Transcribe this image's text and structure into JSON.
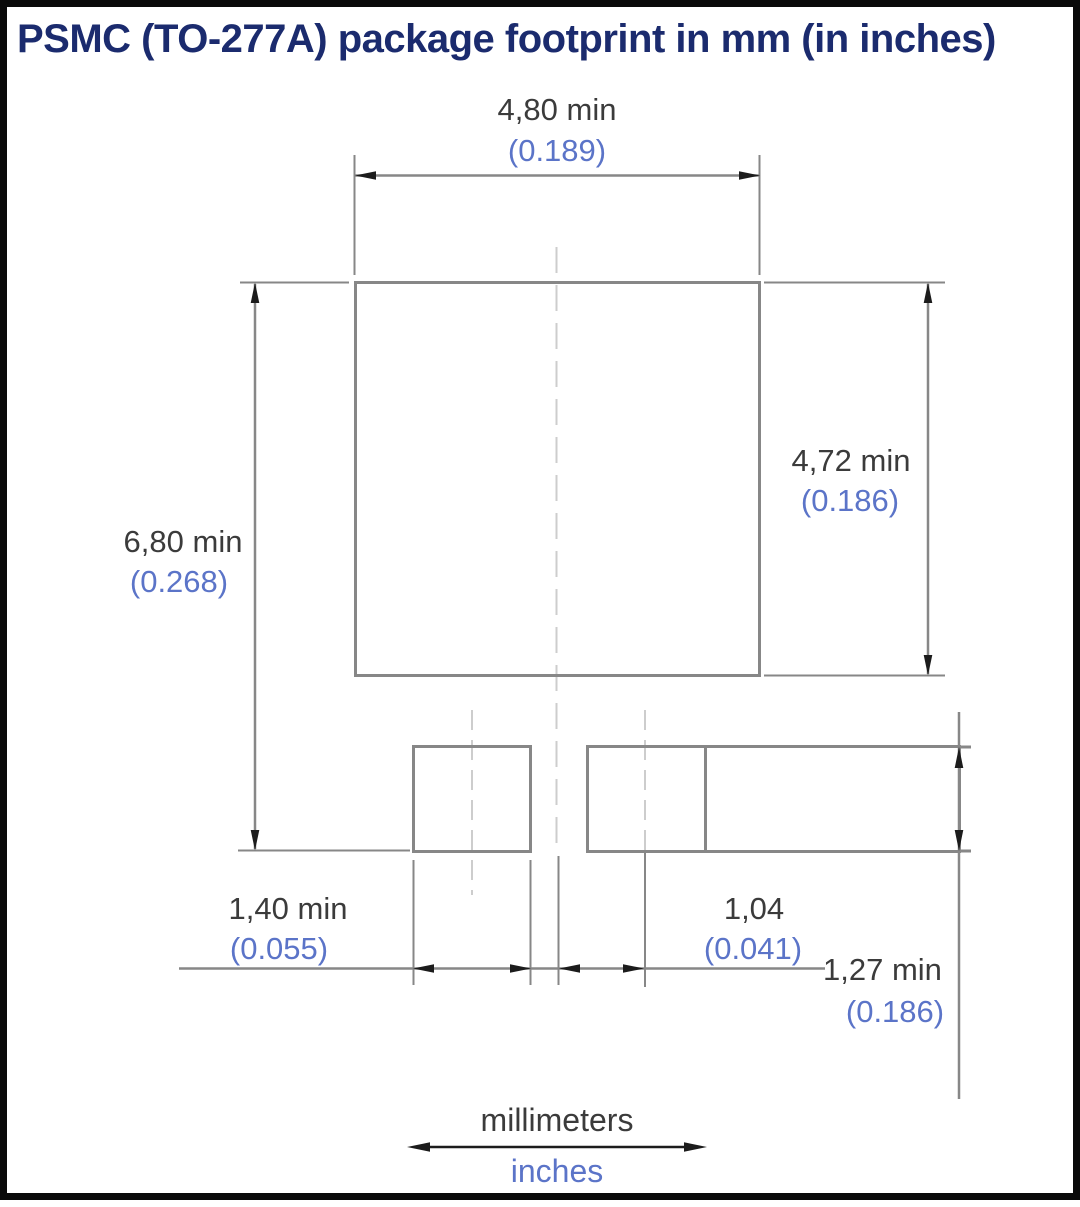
{
  "title": "PSMC (TO-277A) package footprint in mm (in inches)",
  "colors": {
    "title": "#1b2b6e",
    "mm": "#3b3b3b",
    "inch": "#5b74c8",
    "line": "#878787",
    "centerline": "#cdcdcd",
    "arrow": "#1c1c1c",
    "frame": "#0a0a0a"
  },
  "dimensions": {
    "body_width": {
      "mm": "4,80 min",
      "inch": "(0.189)"
    },
    "body_height": {
      "mm": "4,72 min",
      "inch": "(0.186)"
    },
    "overall_height": {
      "mm": "6,80 min",
      "inch": "(0.268)"
    },
    "pad_width": {
      "mm": "1,40 min",
      "inch": "(0.055)"
    },
    "pad_pitch": {
      "mm": "1,04",
      "inch": "(0.041)"
    },
    "pad_height": {
      "mm": "1,27 min",
      "inch": "(0.186)"
    }
  },
  "legend": {
    "mm": "millimeters",
    "inch": "inches"
  }
}
